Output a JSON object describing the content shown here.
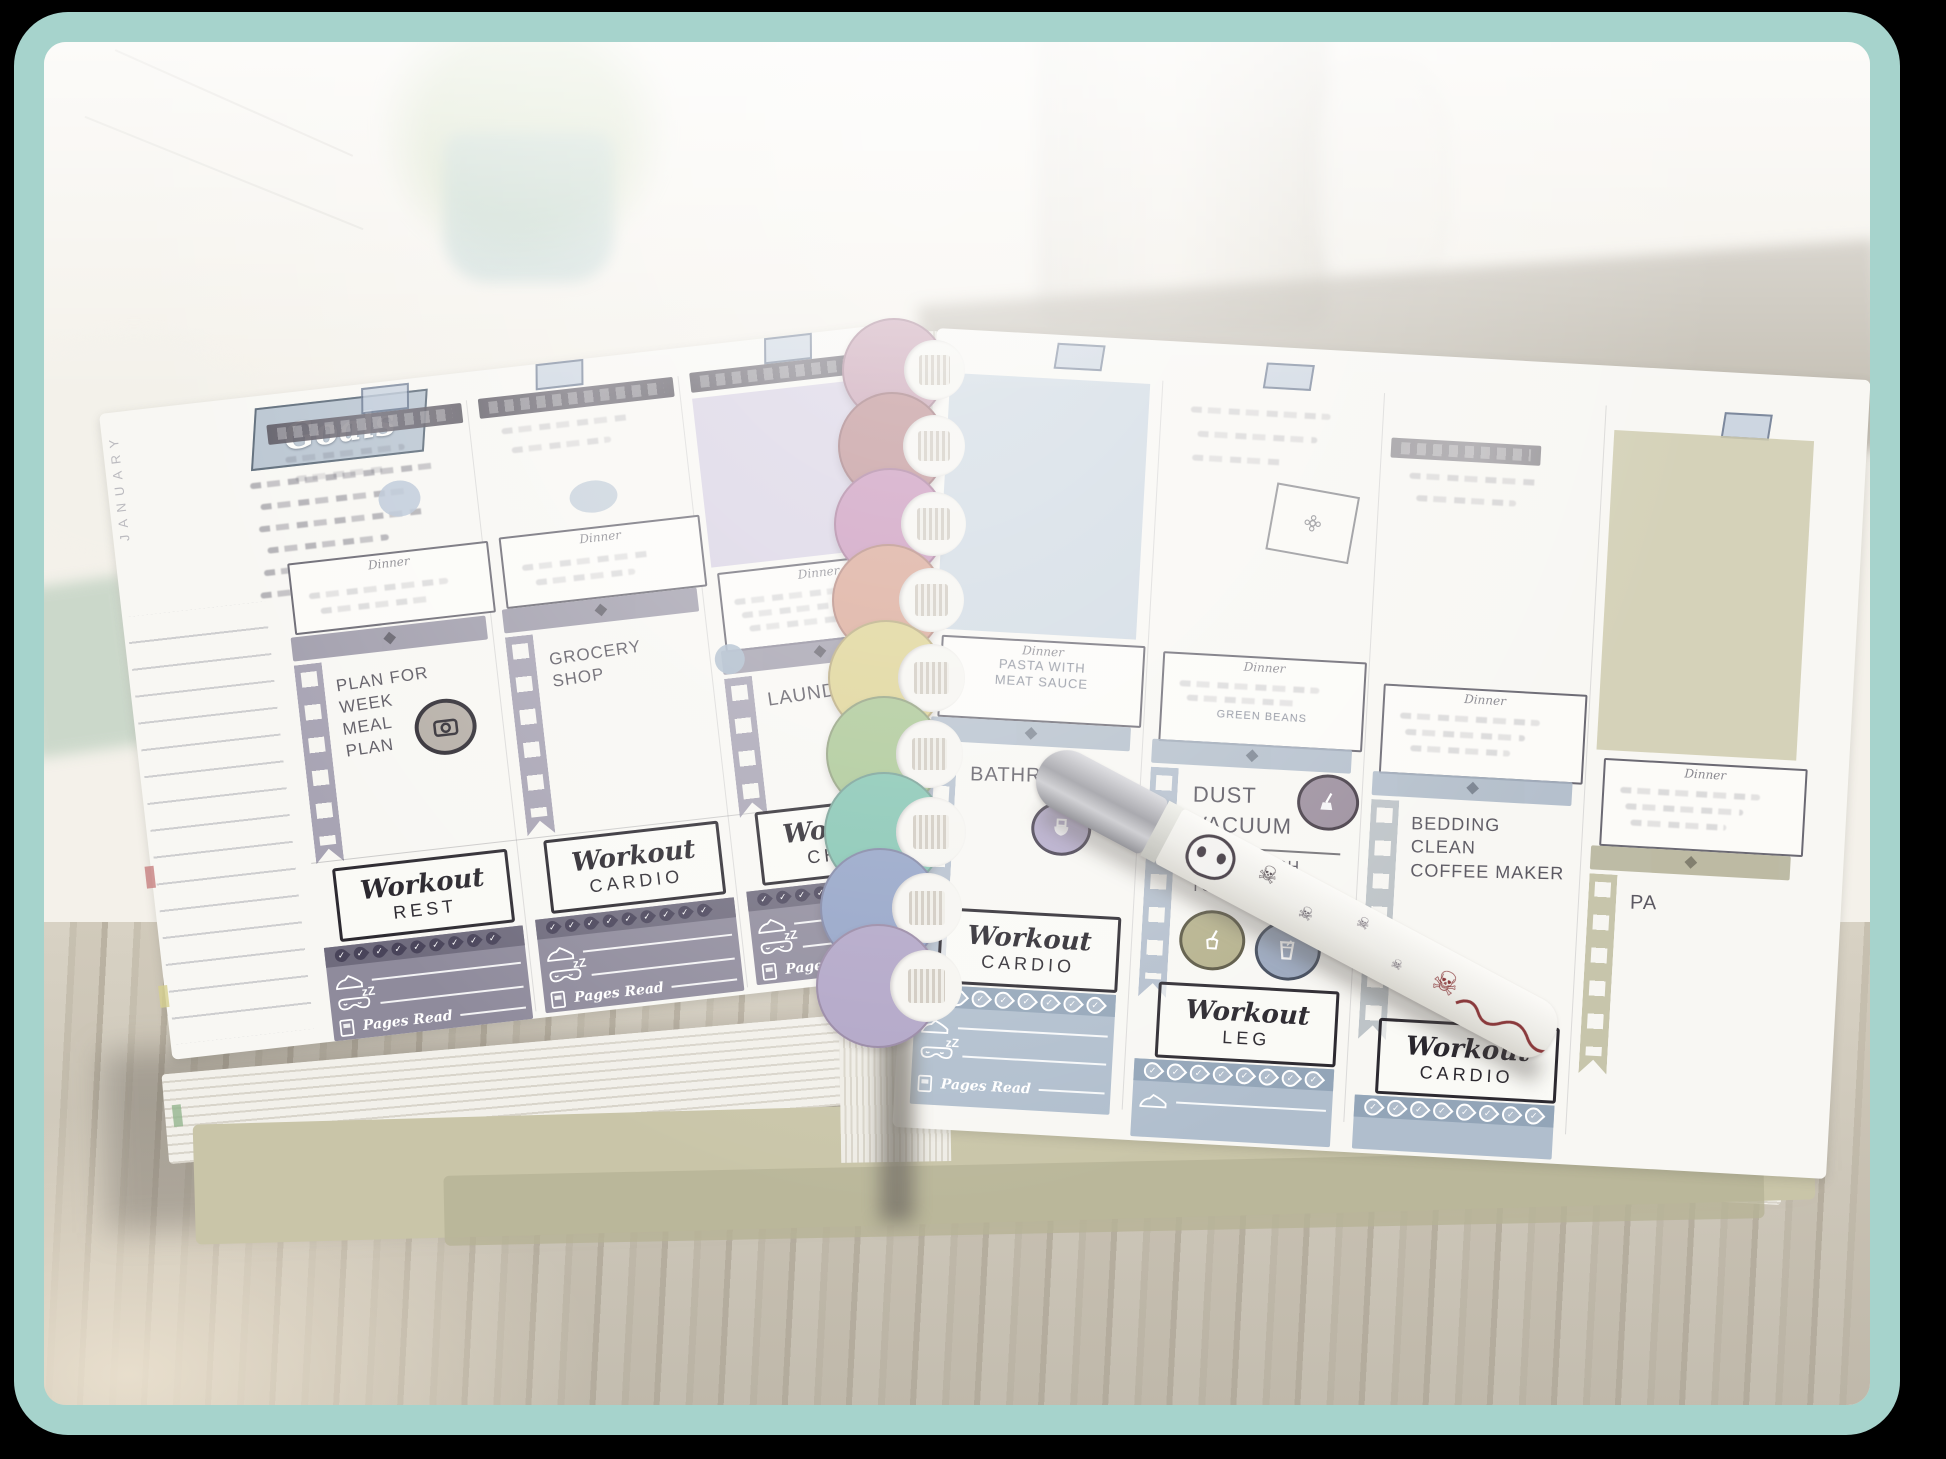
{
  "labels": {
    "month_tab": "JANUARY",
    "goals": "Goals",
    "dinner": "Dinner",
    "workout": "Workout",
    "pages_read": "Pages Read",
    "sleep_zz": "zZ"
  },
  "left_page": {
    "days": [
      {
        "task": "Plan for\nweek\nMeal\nPlan",
        "workout_type": "Rest"
      },
      {
        "task": "Grocery\nShop",
        "workout_type": "Cardio"
      },
      {
        "task": "Laundry",
        "workout_type": "Chest"
      }
    ]
  },
  "right_page": {
    "days": [
      {
        "dinner_text": "Pasta with\nMeat Sauce",
        "task": "Bathrooms",
        "workout_type": "Cardio"
      },
      {
        "dinner_text": "Green Beans",
        "task": "Dust\nVacuum",
        "task_sub": "Take Trash\nto Curb",
        "workout_type": "Leg"
      },
      {
        "task": "Bedding\nClean\nCoffee Maker",
        "workout_type": "Cardio"
      },
      {
        "task": "Pa"
      }
    ]
  },
  "trackers": {
    "water_drops_left": 9,
    "water_drops_right": 8
  },
  "discs": [
    "#c9a3b4",
    "#bd8f92",
    "#c996bb",
    "#d9a695",
    "#ddd292",
    "#a9c693",
    "#83c4b1",
    "#92a2c6",
    "#b0a4c6"
  ],
  "colors": {
    "frame_border": "#a6d3cc",
    "page": "#f8f7f3",
    "washi_header": "#56525c",
    "film_left": "#a09cae",
    "tracker_left": "#8f8b9c",
    "tracker_right": "#b0becd"
  }
}
